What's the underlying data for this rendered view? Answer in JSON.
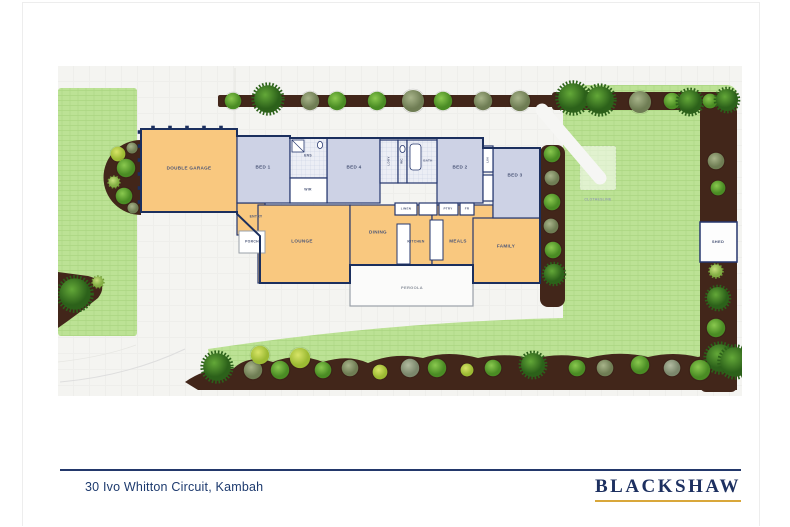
{
  "footer": {
    "address": "30 Ivo Whitton Circuit, Kambah",
    "brand": "BLACKSHAW"
  },
  "rooms": {
    "garage": "DOUBLE GARAGE",
    "bed1": "BED 1",
    "bed2": "BED 2",
    "bed3": "BED 3",
    "bed4": "BED 4",
    "ens": "ENS",
    "wir": "WIR",
    "ldry": "LDRY",
    "wc": "WC",
    "bath": "BATH",
    "lin": "LIN",
    "linen": "LINEN",
    "ptry": "PTRY",
    "fr": "FR",
    "entry": "ENTRY",
    "porch": "PORCH",
    "lounge": "LOUNGE",
    "dining": "DINING",
    "kitchen": "KITCHEN",
    "meals": "MEALS",
    "family": "FAMILY"
  },
  "outdoor": {
    "pergola": "PERGOLA",
    "clothesline": "CLOTHESLINE",
    "shed": "SHED"
  },
  "palette": {
    "wall_navy": "#23386b",
    "living_orange": "#f9c87f",
    "bedroom_blue": "#cdd2e5",
    "garden_brown": "#42261a",
    "lawn_green": "#bce295",
    "paving": "#f4f4f1",
    "footer_navy": "#1d3a6e",
    "brand_gold": "#d9a73a"
  }
}
